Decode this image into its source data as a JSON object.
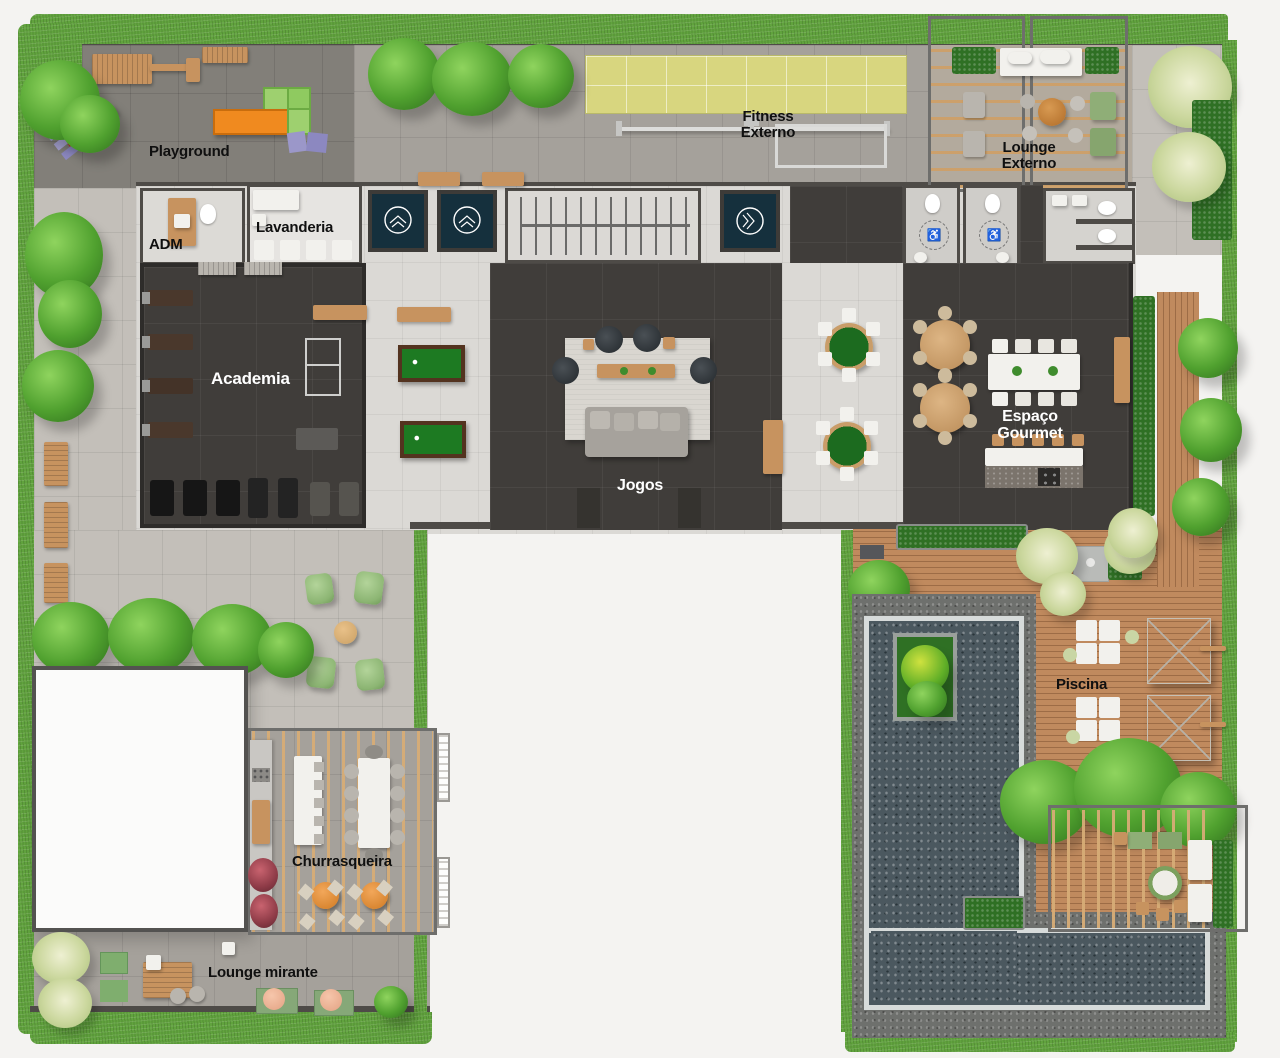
{
  "meta": {
    "plan_type": "rooftop-amenities-floor-plan",
    "language": "pt-BR"
  },
  "palette": {
    "grass": "#61a33e",
    "hedge": "#2f7024",
    "pavement_light": "#c3bfb9",
    "pavement_mid": "#a5a19b",
    "pavement_dark": "#827f79",
    "interior": "#dbd9d5",
    "floor_dark": "#403d3a",
    "wood": "#c7935f",
    "deck": "#c08a5e",
    "pool": "#4b585f",
    "stone": "#6e706d",
    "mat": "#d8d67f",
    "navy": "#15303d",
    "felt": "#1d7a22",
    "white_roof": "#fbfbfa",
    "wall": "#4e4b47",
    "label_dark": "#101010",
    "label_light": "#ffffff",
    "orange": "#e5893a",
    "red": "#e11414",
    "lilac": "#9b97c9",
    "pouf_green": "#96bb80",
    "pink": "#eeb394"
  },
  "labels": {
    "playground": "Playground",
    "adm": "ADM",
    "lavanderia": "Lavanderia",
    "fitness_line1": "Fitness",
    "fitness_line2": "Externo",
    "lounge_externo_line1": "Lounge",
    "lounge_externo_line2": "Externo",
    "academia": "Academia",
    "jogos": "Jogos",
    "gourmet_line1": "Espaço",
    "gourmet_line2": "Gourmet",
    "piscina": "Piscina",
    "churrasqueira": "Churrasqueira",
    "lounge_mirante": "Lounge mirante"
  },
  "icons": {
    "wheelchair": "♿",
    "elevator_logo": "circle-mountain-chevrons"
  }
}
